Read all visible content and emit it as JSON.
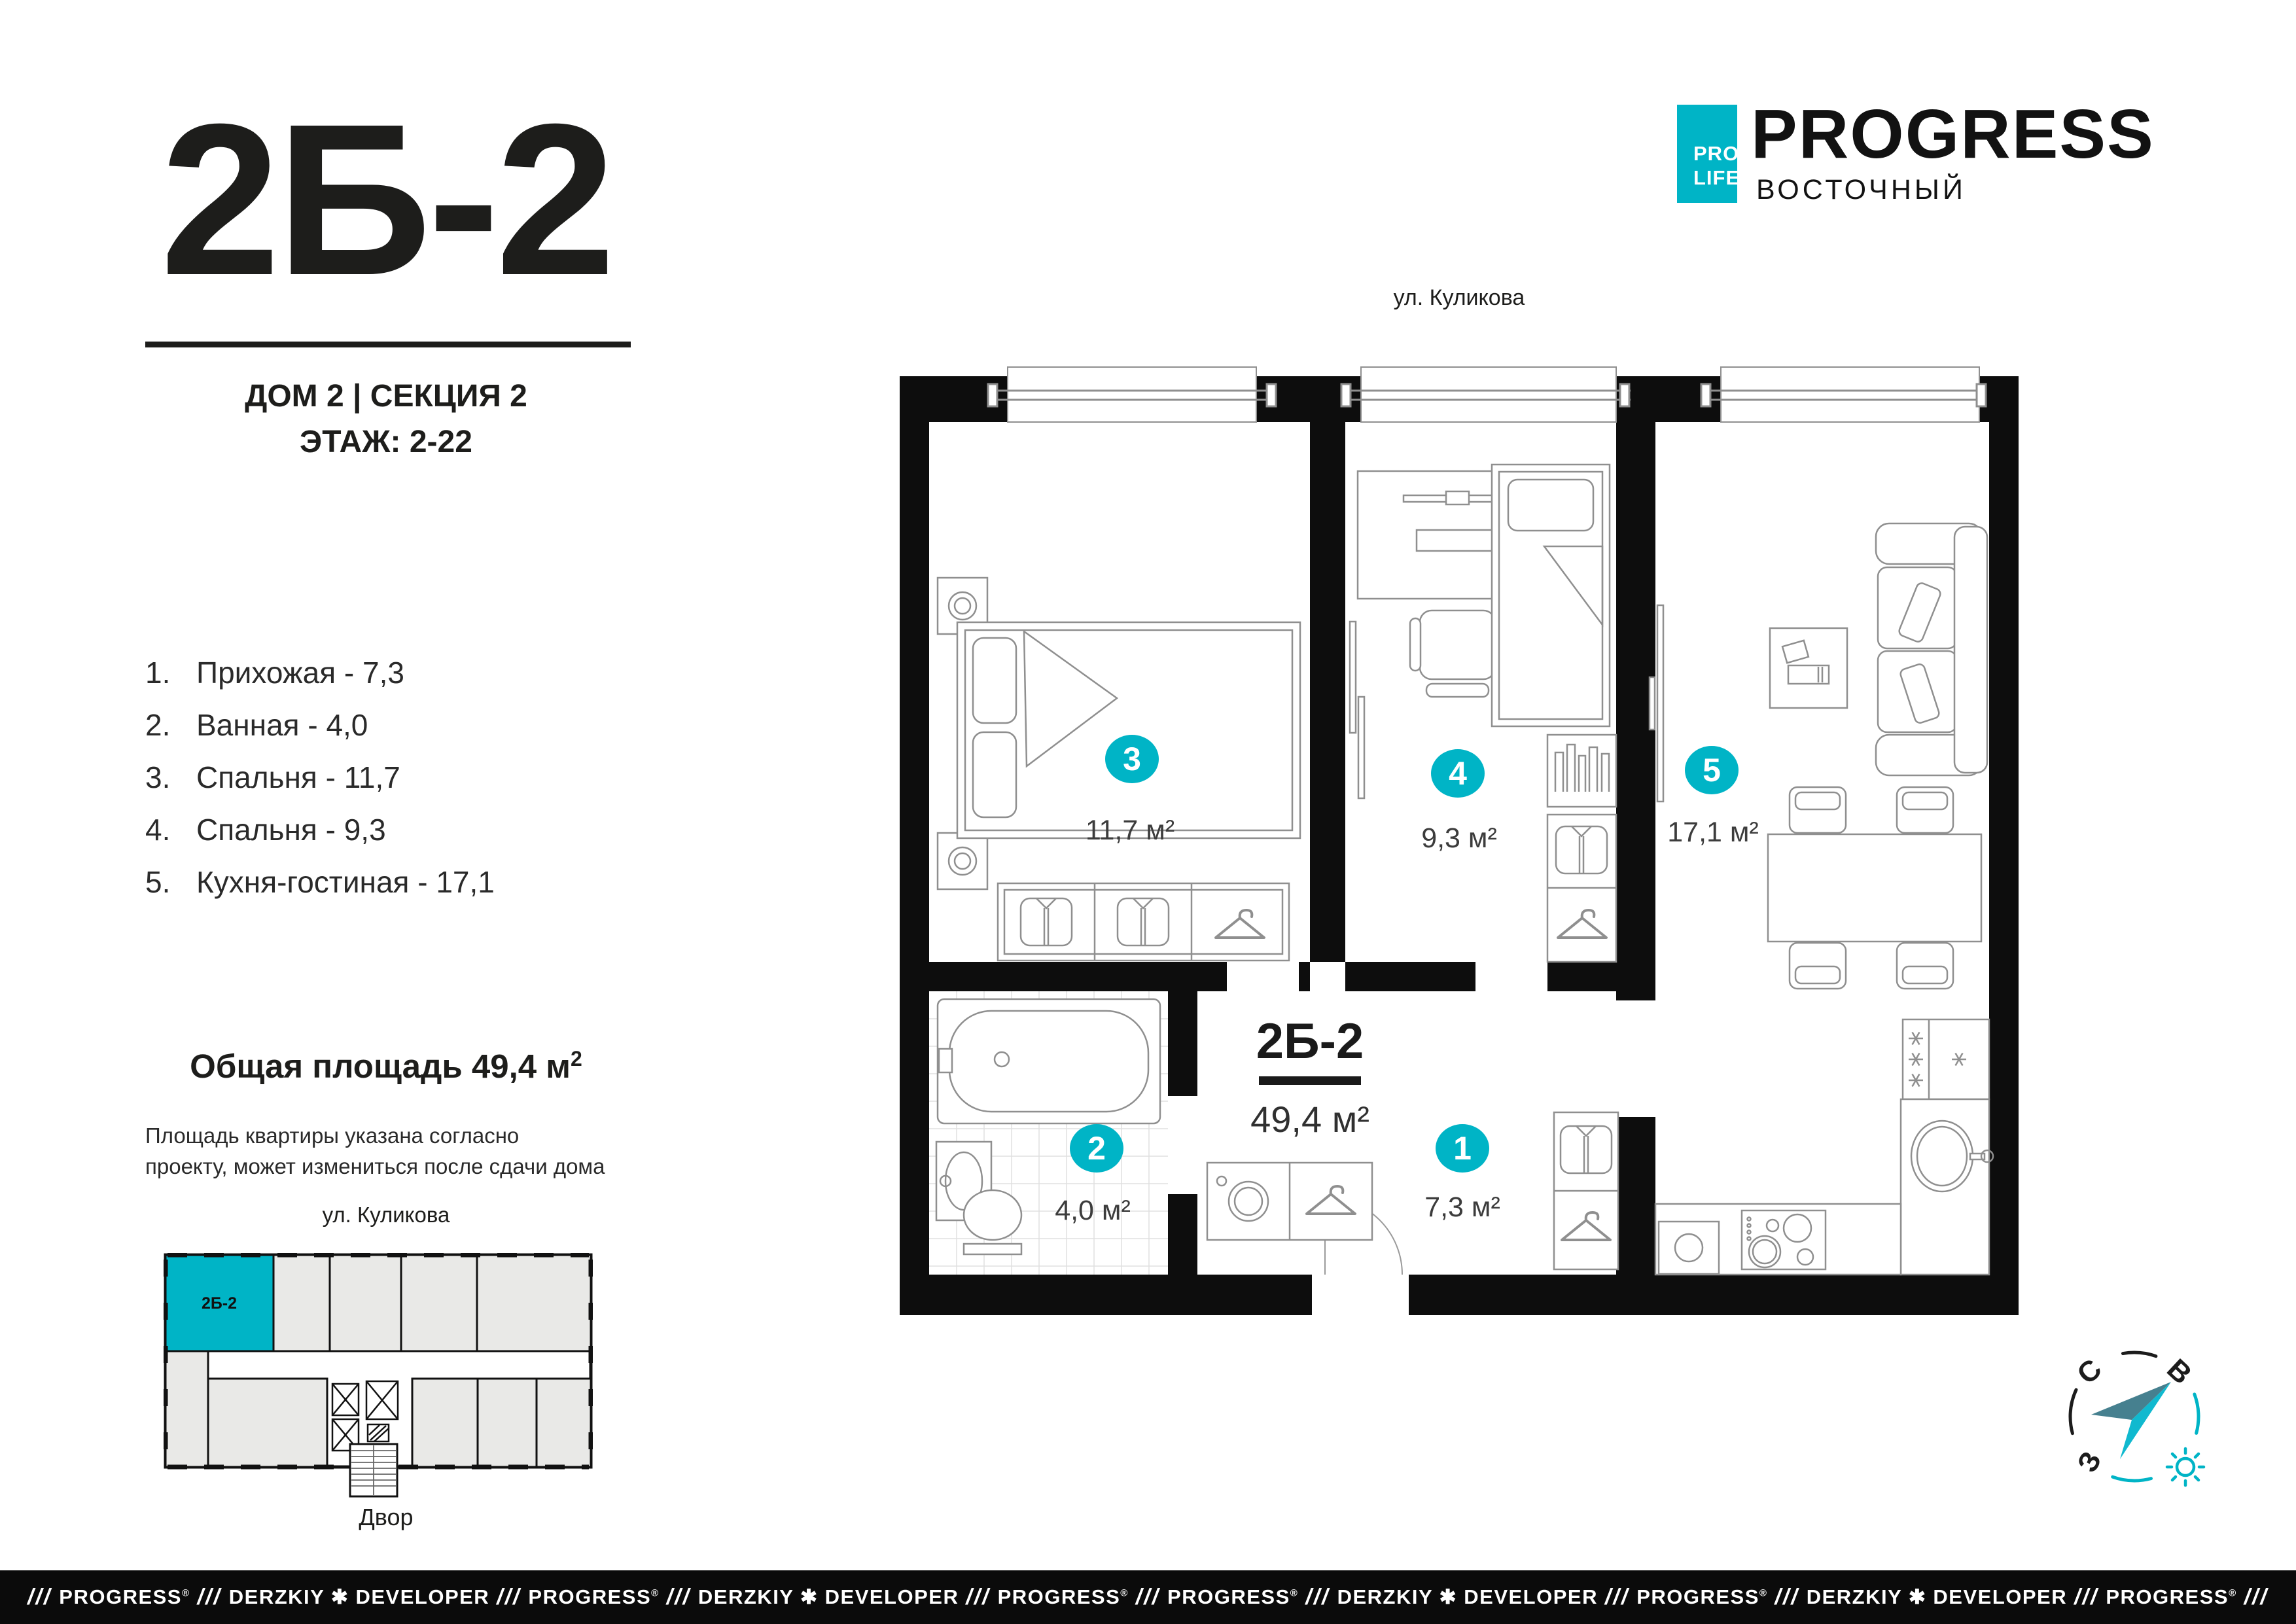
{
  "accent": "#00b4c6",
  "title_block": {
    "apartment_code": "2Б-2",
    "building": "ДОМ 2 | СЕКЦИЯ 2",
    "floor": "ЭТАЖ: 2-22"
  },
  "room_list": [
    {
      "num": "1.",
      "text": "Прихожая - 7,3"
    },
    {
      "num": "2.",
      "text": "Ванная - 4,0"
    },
    {
      "num": "3.",
      "text": "Спальня - 11,7"
    },
    {
      "num": "4.",
      "text": "Спальня - 9,3"
    },
    {
      "num": "5.",
      "text": "Кухня-гостиная - 17,1"
    }
  ],
  "total_area": {
    "text": "Общая площадь 49,4 м",
    "sup": "2"
  },
  "disclaimer_lines": [
    "Площадь квартиры указана согласно",
    "проекту, может измениться после сдачи дома"
  ],
  "street_left": "ул. Куликова",
  "mini_plan": {
    "unit": "2Б-2",
    "yard": "Двор"
  },
  "logo": {
    "pro": "PRO",
    "life": "LIFE",
    "name": "PROGRESS",
    "district": "ВОСТОЧНЫЙ"
  },
  "plan": {
    "street": "ул. Куликова",
    "code": "2Б-2",
    "area": "49,4 м²",
    "badges": [
      {
        "num": "1",
        "area": "7,3 м²"
      },
      {
        "num": "2",
        "area": "4,0 м²"
      },
      {
        "num": "3",
        "area": "11,7 м²"
      },
      {
        "num": "4",
        "area": "9,3 м²"
      },
      {
        "num": "5",
        "area": "17,1 м²"
      }
    ]
  },
  "compass": {
    "n": "С",
    "e": "В",
    "w": "З"
  },
  "footer": {
    "separator": "///",
    "items": [
      {
        "text": "PROGRESS",
        "mark": "®"
      },
      {
        "text": "DERZKIY ✱ DEVELOPER"
      },
      {
        "text": "PROGRESS",
        "mark": "®"
      },
      {
        "text": "DERZKIY ✱ DEVELOPER"
      },
      {
        "text": "PROGRESS",
        "mark": "®"
      },
      {
        "text": "PROGRESS",
        "mark": "®"
      },
      {
        "text": "DERZKIY ✱ DEVELOPER"
      },
      {
        "text": "PROGRESS",
        "mark": "®"
      },
      {
        "text": "DERZKIY ✱ DEVELOPER"
      },
      {
        "text": "PROGRESS",
        "mark": "®"
      }
    ]
  }
}
